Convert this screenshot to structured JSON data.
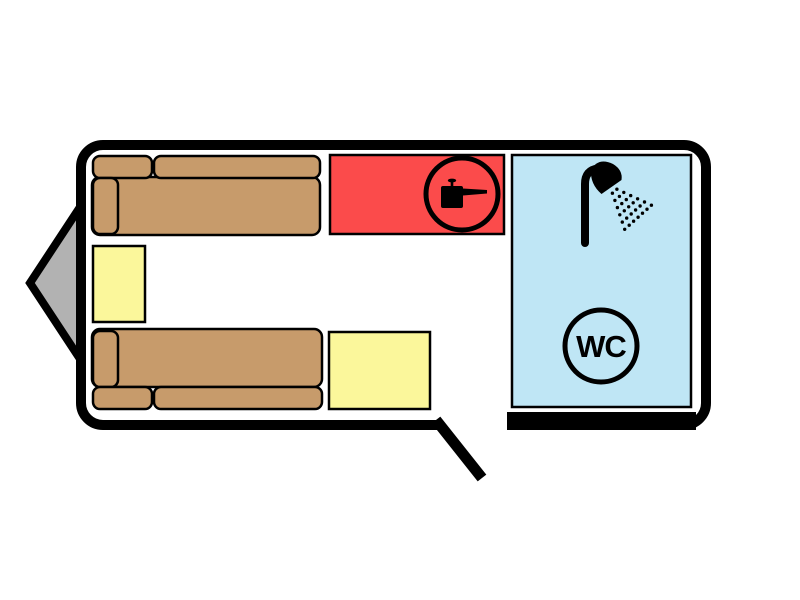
{
  "plan": {
    "name": "caravan-floor-plan",
    "labels": {
      "wc": "WC"
    },
    "colors": {
      "sofa": "#C79B6B",
      "table": "#FBF79B",
      "kitchen": "#FB4B4B",
      "bathroom": "#BFE6F5",
      "hitch": "#B2B2B2",
      "wall": "#000000",
      "floor": "#FFFFFF",
      "icon": "#000000"
    },
    "areas": [
      {
        "id": "sofa-bed-top",
        "kind": "sofa-bed"
      },
      {
        "id": "sofa-bed-bottom",
        "kind": "sofa-bed"
      },
      {
        "id": "side-table-left",
        "kind": "table"
      },
      {
        "id": "center-table",
        "kind": "table"
      },
      {
        "id": "kitchen-unit",
        "kind": "kitchen",
        "icon": "cooking-pot-icon"
      },
      {
        "id": "bathroom",
        "kind": "washroom",
        "icons": [
          "shower-icon",
          "wc-icon"
        ]
      }
    ],
    "features": [
      {
        "id": "hitch",
        "kind": "drawbar-triangle"
      },
      {
        "id": "entry-door",
        "kind": "door-opening",
        "side": "bottom"
      }
    ]
  }
}
